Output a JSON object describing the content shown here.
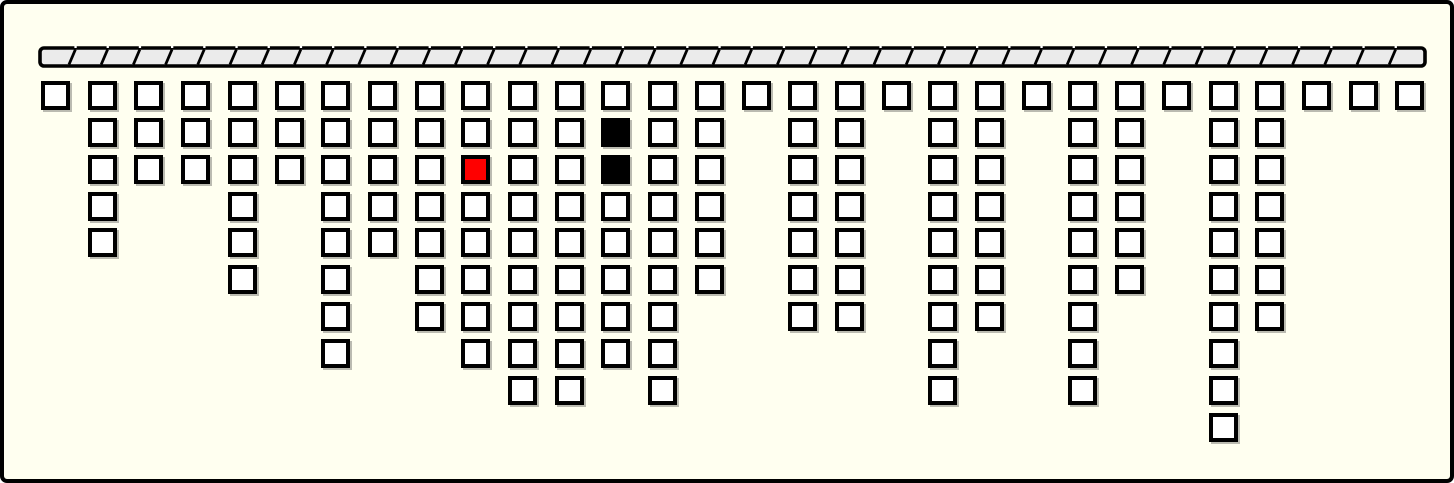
{
  "window": {
    "width": 1454,
    "height": 483,
    "background": "#FFFFF0",
    "border_color": "#000000",
    "border_width": 4,
    "corner_radius": 7
  },
  "ceiling_bar": {
    "x": 34,
    "y": 41,
    "width": 1390,
    "height": 24,
    "fill": "#EBEBEB",
    "border_color": "#000000",
    "segment_count": 43,
    "segment_width": 32.2,
    "divider_slant": 6.4,
    "divider_color": "#000000",
    "dot_color": "#FFFFFF"
  },
  "board": {
    "columns": 30,
    "max_rows": 10,
    "grid": {
      "origin_x": 37,
      "origin_y": 77,
      "col_spacing": 46.7,
      "row_spacing": 36.85,
      "cell_size": 29
    },
    "cell_style": {
      "fill": "#FFFFFF",
      "border_color": "#000000",
      "shadow_color": "#3C3C3C"
    },
    "column_depths": [
      1,
      5,
      3,
      3,
      6,
      3,
      8,
      5,
      7,
      8,
      9,
      9,
      8,
      9,
      6,
      1,
      7,
      7,
      1,
      9,
      7,
      1,
      9,
      6,
      1,
      10,
      7,
      1,
      1,
      1
    ],
    "highlighted_cells": [
      {
        "col": 9,
        "row": 2,
        "fill": "#FF0000",
        "name": "cell-red"
      },
      {
        "col": 12,
        "row": 1,
        "fill": "#000000",
        "name": "cell-black"
      },
      {
        "col": 12,
        "row": 2,
        "fill": "#000000",
        "name": "cell-black"
      }
    ]
  }
}
